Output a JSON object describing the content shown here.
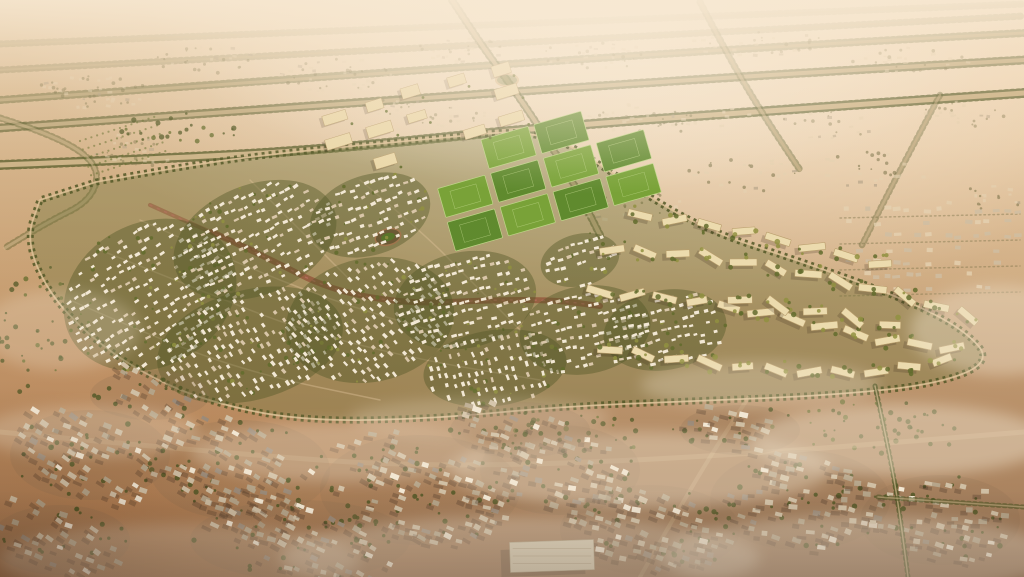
{
  "meta": {
    "description": "Aerial golden-hour rendering of a master-planned desert community: a leaf-shaped district of white villa clusters among green trees, green sports fields and a beige campus at its top edge, curved rows of beige apartment blocks on the east side, all ringed by a tree-lined loop road; straight tree-lined avenues cross the hazy desert beyond, and a dusty existing low-rise town with long shadows and drifting mist fills the foreground."
  },
  "palette": {
    "treeDark": "#4a5423",
    "treeMid": "#5c6a2a",
    "treeLit": "#8d9140",
    "villa": "#f4ecdb",
    "villaDim": "#d9c9ad",
    "field": "#59892c",
    "fieldLight": "#74a336",
    "fieldLine": "#bcd98a",
    "campus": "#ecdcae",
    "apt": "#eddfb2",
    "aptShade": "#b89f6e",
    "roadLight": "#dcc298",
    "parkRed": "#8e4e36",
    "parkPink": "#c4706b",
    "townA": "#cfc1a8",
    "townB": "#b2a48b",
    "townC": "#97897a",
    "shadow": "#35291d",
    "distant": "#e6d5b6",
    "distantTree": "#6f6c44",
    "fog": "#f3e8d4",
    "dirt": "#d9c096",
    "interior": "#6d743d",
    "oval": "#7a5a3f",
    "bigBuilding": "#dcd3bc"
  },
  "scene": {
    "seed": 7,
    "communityOutline": [
      [
        96,
        182
      ],
      [
        200,
        163
      ],
      [
        310,
        150
      ],
      [
        430,
        139
      ],
      [
        545,
        128
      ],
      [
        625,
        182
      ],
      [
        705,
        230
      ],
      [
        800,
        261
      ],
      [
        900,
        297
      ],
      [
        965,
        330
      ],
      [
        992,
        362
      ],
      [
        935,
        385
      ],
      [
        820,
        396
      ],
      [
        690,
        401
      ],
      [
        555,
        407
      ],
      [
        430,
        419
      ],
      [
        300,
        421
      ],
      [
        205,
        401
      ],
      [
        140,
        372
      ],
      [
        88,
        335
      ],
      [
        48,
        292
      ],
      [
        26,
        240
      ],
      [
        40,
        200
      ]
    ],
    "villaClusters": [
      {
        "x": 150,
        "y": 295,
        "rx": 90,
        "ry": 72,
        "rot": -28,
        "row": -32
      },
      {
        "x": 255,
        "y": 240,
        "rx": 85,
        "ry": 55,
        "rot": -22,
        "row": -28
      },
      {
        "x": 250,
        "y": 345,
        "rx": 95,
        "ry": 55,
        "rot": -15,
        "row": 55
      },
      {
        "x": 370,
        "y": 320,
        "rx": 85,
        "ry": 62,
        "rot": -12,
        "row": 48
      },
      {
        "x": 370,
        "y": 215,
        "rx": 62,
        "ry": 40,
        "rot": -18,
        "row": -22
      },
      {
        "x": 465,
        "y": 300,
        "rx": 72,
        "ry": 48,
        "rot": -12,
        "row": -18
      },
      {
        "x": 495,
        "y": 368,
        "rx": 72,
        "ry": 38,
        "rot": -8,
        "row": 70
      },
      {
        "x": 585,
        "y": 330,
        "rx": 66,
        "ry": 44,
        "rot": -10,
        "row": -14
      },
      {
        "x": 665,
        "y": 330,
        "rx": 62,
        "ry": 40,
        "rot": -10,
        "row": -16
      },
      {
        "x": 580,
        "y": 260,
        "rx": 40,
        "ry": 26,
        "rot": -14,
        "row": -18
      }
    ],
    "fields": {
      "x0": 428,
      "y0": 155,
      "cols": 4,
      "rows": 3,
      "cw": 49,
      "ch": 30,
      "gapx": 6,
      "gapy": 5,
      "angle": -16,
      "skip": [
        [
          0,
          0
        ],
        [
          3,
          0
        ]
      ]
    },
    "campus": {
      "x0": 330,
      "y0": 118,
      "cols": 5,
      "rows": 3,
      "dx": 44,
      "dy": 27,
      "angle": -17,
      "w": 21,
      "h": 9,
      "skip": 0.3
    },
    "aptRows": [
      {
        "pts": [
          [
            612,
            250
          ],
          [
            700,
            255
          ],
          [
            800,
            272
          ],
          [
            900,
            295
          ],
          [
            968,
            316
          ]
        ],
        "n": 12,
        "w": 25,
        "h": 7,
        "alt": 22
      },
      {
        "pts": [
          [
            600,
            292
          ],
          [
            690,
            300
          ],
          [
            790,
            318
          ],
          [
            885,
            340
          ],
          [
            952,
            348
          ]
        ],
        "n": 12,
        "w": 24,
        "h": 7,
        "alt": -20
      },
      {
        "pts": [
          [
            610,
            350
          ],
          [
            700,
            362
          ],
          [
            795,
            372
          ],
          [
            878,
            372
          ],
          [
            942,
            360
          ]
        ],
        "n": 11,
        "w": 23,
        "h": 7,
        "alt": 18
      },
      {
        "pts": [
          [
            640,
            215
          ],
          [
            730,
            228
          ],
          [
            815,
            248
          ],
          [
            880,
            264
          ]
        ],
        "n": 8,
        "w": 24,
        "h": 7,
        "alt": -16
      },
      {
        "pts": [
          [
            740,
            300
          ],
          [
            820,
            312
          ],
          [
            890,
            325
          ]
        ],
        "n": 5,
        "w": 22,
        "h": 7,
        "alt": 26
      }
    ],
    "avenues": [
      {
        "pts": [
          [
            0,
            165
          ],
          [
            180,
            158
          ],
          [
            330,
            149
          ],
          [
            545,
            127
          ],
          [
            780,
            110
          ],
          [
            1024,
            93
          ]
        ],
        "w": 5,
        "o": 0.85
      },
      {
        "pts": [
          [
            0,
            128
          ],
          [
            350,
            103
          ],
          [
            700,
            79
          ],
          [
            1024,
            60
          ]
        ],
        "w": 4,
        "o": 0.7
      },
      {
        "pts": [
          [
            0,
            100
          ],
          [
            400,
            71
          ],
          [
            800,
            45
          ],
          [
            1024,
            33
          ]
        ],
        "w": 3,
        "o": 0.5
      },
      {
        "pts": [
          [
            0,
            70
          ],
          [
            1024,
            16
          ]
        ],
        "w": 2,
        "o": 0.3
      },
      {
        "pts": [
          [
            0,
            44
          ],
          [
            1024,
            4
          ]
        ],
        "w": 2,
        "o": 0.22
      }
    ],
    "crossings": [
      {
        "pts": [
          [
            452,
            0
          ],
          [
            478,
            40
          ],
          [
            507,
            80
          ],
          [
            540,
            128
          ],
          [
            575,
            185
          ],
          [
            600,
            235
          ]
        ],
        "w": 4,
        "o": 0.7
      },
      {
        "pts": [
          [
            700,
            2
          ],
          [
            726,
            52
          ],
          [
            760,
            110
          ],
          [
            800,
            170
          ]
        ],
        "w": 3,
        "o": 0.5
      },
      {
        "pts": [
          [
            940,
            95
          ],
          [
            900,
            170
          ],
          [
            862,
            245
          ]
        ],
        "w": 2.5,
        "o": 0.45
      },
      {
        "pts": [
          [
            0,
            118
          ],
          [
            55,
            135
          ],
          [
            100,
            165
          ],
          [
            92,
            200
          ],
          [
            48,
            222
          ],
          [
            5,
            248
          ]
        ],
        "w": 3,
        "o": 0.5
      }
    ],
    "dirtRoads": [
      {
        "pts": [
          [
            0,
            432
          ],
          [
            210,
            452
          ],
          [
            430,
            468
          ],
          [
            700,
            458
          ],
          [
            1024,
            432
          ]
        ],
        "w": 5,
        "o": 0.3
      },
      {
        "pts": [
          [
            640,
            577
          ],
          [
            695,
            480
          ],
          [
            748,
            398
          ]
        ],
        "w": 4,
        "o": 0.3
      }
    ],
    "treeLines": [
      {
        "pts": [
          [
            875,
            386
          ],
          [
            890,
            455
          ],
          [
            900,
            515
          ],
          [
            908,
            577
          ]
        ],
        "o": 0.8
      },
      {
        "pts": [
          [
            878,
            497
          ],
          [
            950,
            502
          ],
          [
            1024,
            507
          ]
        ],
        "o": 0.6
      }
    ],
    "roundabout": {
      "x": 507,
      "y": 80,
      "rx": 11,
      "ry": 6
    },
    "parkSpines": [
      {
        "pts": [
          [
            212,
            232
          ],
          [
            268,
            258
          ],
          [
            330,
            290
          ],
          [
            408,
            304
          ],
          [
            488,
            300
          ],
          [
            555,
            300
          ],
          [
            600,
            306
          ]
        ],
        "w": 6,
        "o": 0.75
      },
      {
        "pts": [
          [
            150,
            205
          ],
          [
            205,
            230
          ],
          [
            255,
            250
          ]
        ],
        "w": 4,
        "o": 0.5
      }
    ],
    "ovalPark": {
      "x": 388,
      "y": 237,
      "rx": 13,
      "ry": 8,
      "rot": -15
    },
    "streets": [
      [
        [
          100,
          250
        ],
        [
          200,
          290
        ],
        [
          300,
          330
        ],
        [
          420,
          360
        ],
        [
          540,
          380
        ]
      ],
      [
        [
          140,
          220
        ],
        [
          230,
          260
        ],
        [
          330,
          300
        ],
        [
          430,
          330
        ]
      ],
      [
        [
          70,
          300
        ],
        [
          160,
          340
        ],
        [
          260,
          375
        ],
        [
          380,
          400
        ]
      ],
      [
        [
          360,
          180
        ],
        [
          420,
          230
        ],
        [
          470,
          280
        ],
        [
          520,
          330
        ]
      ],
      [
        [
          250,
          180
        ],
        [
          300,
          230
        ],
        [
          350,
          280
        ]
      ]
    ],
    "topClusters": [
      {
        "x": 95,
        "y": 92,
        "rx": 60,
        "ry": 16,
        "n": 26
      },
      {
        "x": 210,
        "y": 60,
        "rx": 55,
        "ry": 14,
        "n": 20
      },
      {
        "x": 340,
        "y": 75,
        "rx": 60,
        "ry": 18,
        "n": 22
      },
      {
        "x": 460,
        "y": 50,
        "rx": 45,
        "ry": 12,
        "n": 14
      },
      {
        "x": 600,
        "y": 55,
        "rx": 60,
        "ry": 14,
        "n": 16
      },
      {
        "x": 760,
        "y": 45,
        "rx": 70,
        "ry": 14,
        "n": 16
      },
      {
        "x": 910,
        "y": 60,
        "rx": 60,
        "ry": 14,
        "n": 14
      },
      {
        "x": 960,
        "y": 115,
        "rx": 45,
        "ry": 14,
        "n": 12
      },
      {
        "x": 830,
        "y": 125,
        "rx": 55,
        "ry": 14,
        "n": 12
      },
      {
        "x": 640,
        "y": 120,
        "rx": 55,
        "ry": 16,
        "n": 14
      },
      {
        "x": 420,
        "y": 115,
        "rx": 70,
        "ry": 18,
        "n": 20
      },
      {
        "x": 135,
        "y": 150,
        "rx": 40,
        "ry": 18,
        "n": 16
      }
    ],
    "upperRightFabric": [
      {
        "x": 620,
        "y": 200,
        "rx": 60,
        "ry": 20,
        "n": 16
      },
      {
        "x": 740,
        "y": 175,
        "rx": 60,
        "ry": 18,
        "n": 14
      },
      {
        "x": 870,
        "y": 170,
        "rx": 60,
        "ry": 18,
        "n": 14
      },
      {
        "x": 980,
        "y": 200,
        "rx": 40,
        "ry": 16,
        "n": 10
      },
      {
        "x": 700,
        "y": 120,
        "rx": 55,
        "ry": 14,
        "n": 10
      }
    ],
    "existingRight": {
      "x0": 848,
      "y0": 210,
      "x1": 1020,
      "y1": 298,
      "stepX": 10,
      "stepY": 13,
      "lines": [
        218,
        244,
        270,
        296
      ]
    },
    "orchard": {
      "x": 125,
      "y": 150,
      "rows": 5,
      "len": 80,
      "angle": -18,
      "gap": 9
    },
    "treePatches": [
      {
        "x": 35,
        "y": 330,
        "rx": 40,
        "ry": 70,
        "n": 34
      },
      {
        "x": 870,
        "y": 428,
        "rx": 100,
        "ry": 28,
        "n": 44
      },
      {
        "x": 600,
        "y": 432,
        "rx": 120,
        "ry": 20,
        "n": 30
      },
      {
        "x": 180,
        "y": 128,
        "rx": 60,
        "ry": 18,
        "n": 24
      }
    ],
    "bottomClusters": [
      {
        "x": 90,
        "y": 455,
        "rx": 80,
        "ry": 45,
        "row": 28
      },
      {
        "x": 240,
        "y": 470,
        "rx": 90,
        "ry": 50,
        "row": 25
      },
      {
        "x": 420,
        "y": 490,
        "rx": 100,
        "ry": 55,
        "row": 20
      },
      {
        "x": 300,
        "y": 540,
        "rx": 110,
        "ry": 40,
        "row": 22
      },
      {
        "x": 560,
        "y": 470,
        "rx": 80,
        "ry": 45,
        "row": 15
      },
      {
        "x": 650,
        "y": 530,
        "rx": 90,
        "ry": 45,
        "row": 18
      },
      {
        "x": 800,
        "y": 500,
        "rx": 90,
        "ry": 50,
        "row": 12
      },
      {
        "x": 940,
        "y": 520,
        "rx": 80,
        "ry": 45,
        "row": 10
      },
      {
        "x": 520,
        "y": 430,
        "rx": 70,
        "ry": 28,
        "row": 18
      },
      {
        "x": 150,
        "y": 395,
        "rx": 60,
        "ry": 25,
        "row": 30
      },
      {
        "x": 740,
        "y": 430,
        "rx": 60,
        "ry": 25,
        "row": 14
      },
      {
        "x": 60,
        "y": 540,
        "rx": 70,
        "ry": 35,
        "row": 26
      }
    ],
    "bigBuilding": {
      "x": 552,
      "y": 556,
      "w": 84,
      "h": 30,
      "angle": -2
    },
    "fog": [
      {
        "x": 340,
        "y": 452,
        "rx": 150,
        "ry": 30,
        "o": 0.32
      },
      {
        "x": 90,
        "y": 432,
        "rx": 110,
        "ry": 26,
        "o": 0.3
      },
      {
        "x": 640,
        "y": 470,
        "rx": 190,
        "ry": 38,
        "o": 0.4
      },
      {
        "x": 900,
        "y": 440,
        "rx": 150,
        "ry": 36,
        "o": 0.45
      },
      {
        "x": 1000,
        "y": 330,
        "rx": 90,
        "ry": 45,
        "o": 0.4
      },
      {
        "x": 520,
        "y": 558,
        "rx": 240,
        "ry": 42,
        "o": 0.38
      },
      {
        "x": 860,
        "y": 556,
        "rx": 200,
        "ry": 40,
        "o": 0.42
      },
      {
        "x": 180,
        "y": 560,
        "rx": 180,
        "ry": 36,
        "o": 0.3
      },
      {
        "x": 760,
        "y": 385,
        "rx": 120,
        "ry": 24,
        "o": 0.3
      },
      {
        "x": 480,
        "y": 418,
        "rx": 130,
        "ry": 20,
        "o": 0.25
      },
      {
        "x": 60,
        "y": 330,
        "rx": 80,
        "ry": 40,
        "o": 0.25
      }
    ]
  }
}
